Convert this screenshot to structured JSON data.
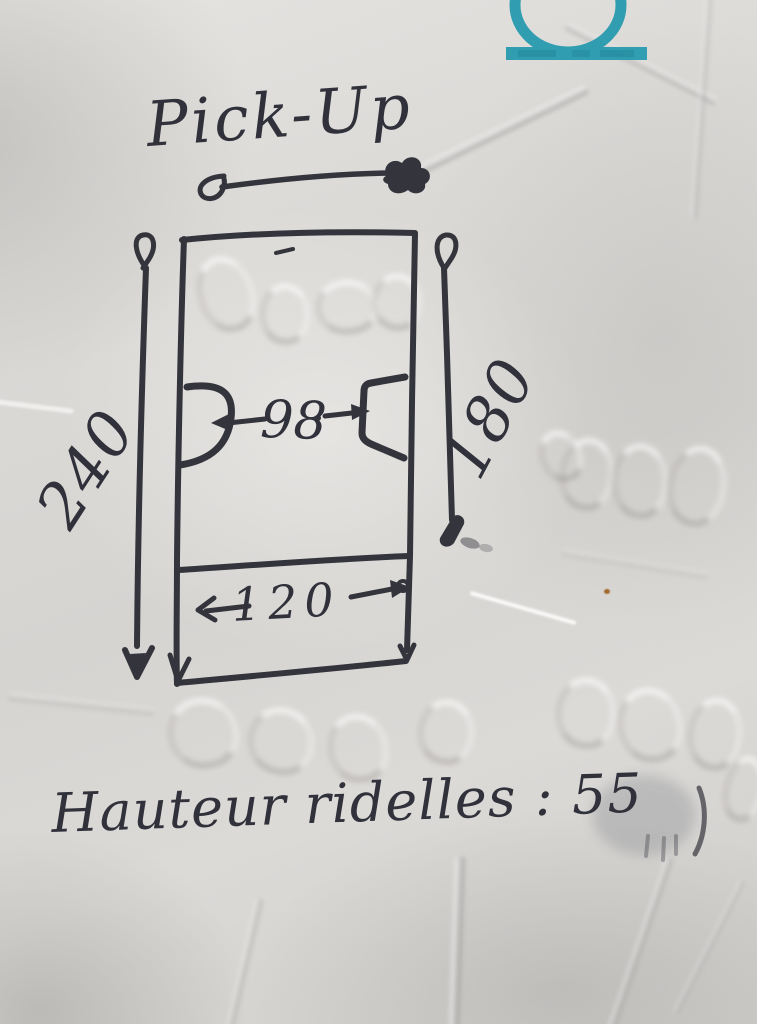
{
  "sketch": {
    "title": "Pick-Up",
    "note": "Hauteur ridelles : 55",
    "dimensions": {
      "overall_length": "240",
      "inner_length": "180",
      "between_wheel_arches": "98",
      "tailgate_width": "120"
    },
    "colors": {
      "ink": "#34343c",
      "paper": "#d9d7d4",
      "logo_teal": "#1f97ad"
    },
    "logo": "teal-omega-stamp"
  }
}
